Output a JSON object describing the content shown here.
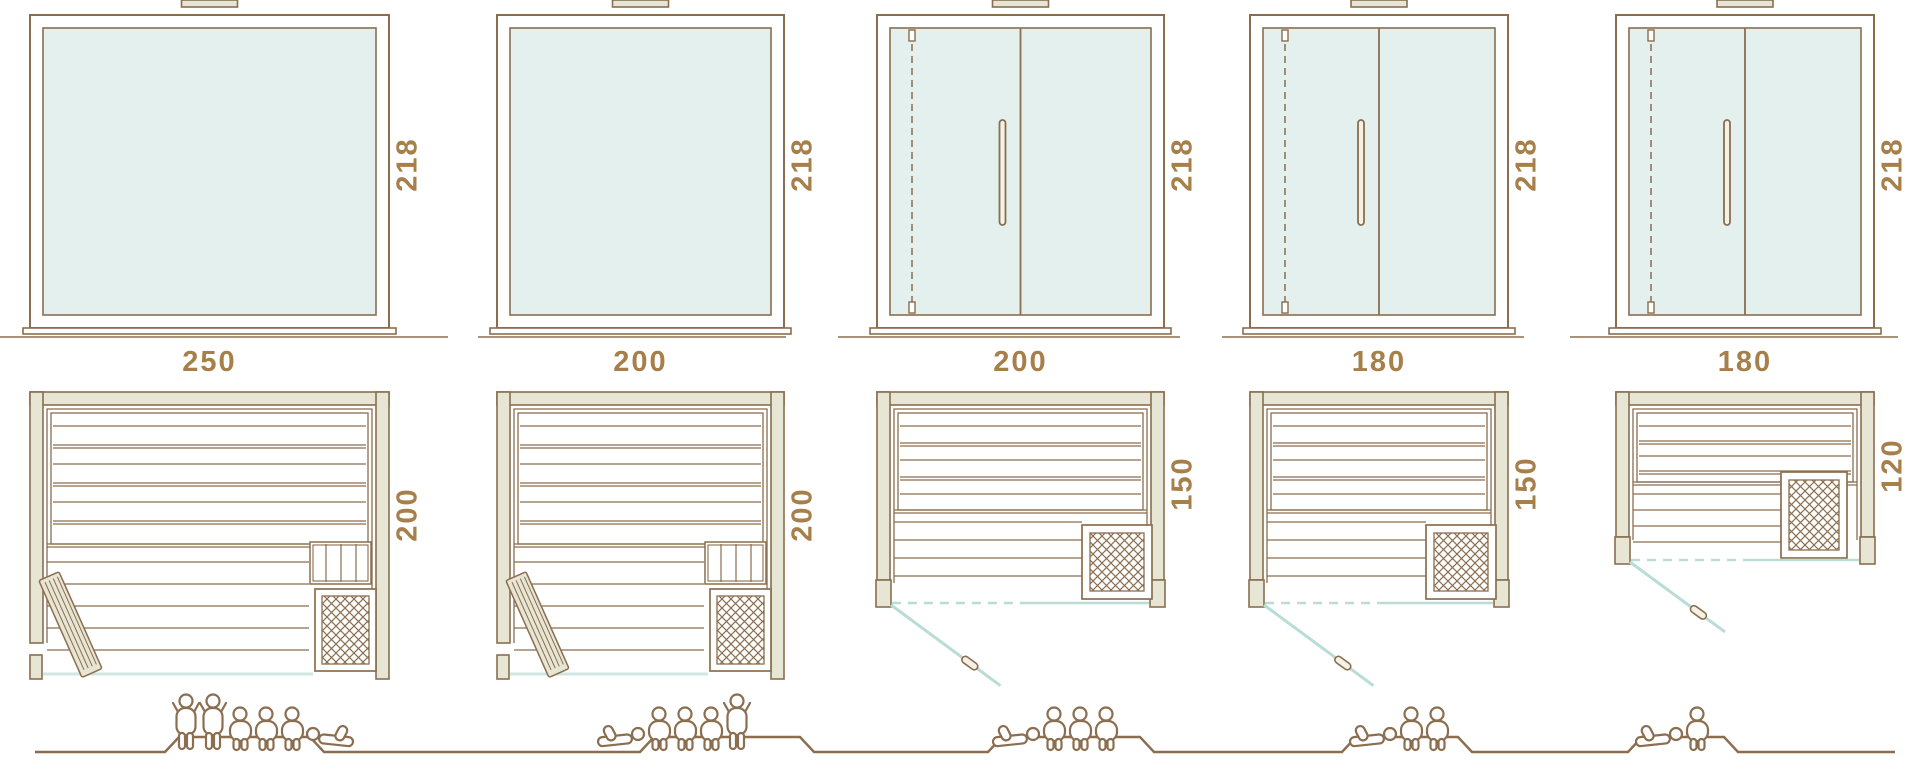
{
  "palette": {
    "line": "#8a6e4f",
    "label_text": "#a67f4a",
    "wall_fill": "#e7e5d4",
    "panel_fill": "#f4f1e6",
    "glass_fill": "#e3f0ee",
    "glass_line": "#b9dcd6",
    "front_glass_line": "#cfe7e2",
    "background": "#ffffff"
  },
  "saunas": [
    {
      "name": "sauna-250x200",
      "width_label": "250",
      "depth_label": "200",
      "height_label": "218",
      "width_cm": 250,
      "depth_cm": 200,
      "height_cm": 218,
      "elevation_door": "fixed-glass",
      "plan_door": "hinged-wood-left",
      "capacity": {
        "standing": 2,
        "sitting": 3,
        "lying": 1
      },
      "figures": [
        "standing",
        "standing",
        "sitting",
        "sitting",
        "sitting",
        "lying-head-left"
      ]
    },
    {
      "name": "sauna-200x200",
      "width_label": "200",
      "depth_label": "200",
      "height_label": "218",
      "width_cm": 200,
      "depth_cm": 200,
      "height_cm": 218,
      "elevation_door": "fixed-glass",
      "plan_door": "hinged-wood-left",
      "capacity": {
        "standing": 1,
        "sitting": 3,
        "lying": 1
      },
      "figures": [
        "lying-head-right",
        "sitting",
        "sitting",
        "sitting",
        "standing"
      ]
    },
    {
      "name": "sauna-200x150",
      "width_label": "200",
      "depth_label": "150",
      "height_label": "218",
      "width_cm": 200,
      "depth_cm": 150,
      "height_cm": 218,
      "elevation_door": "double-glass",
      "plan_door": "glass-front-left",
      "capacity": {
        "standing": 0,
        "sitting": 3,
        "lying": 1
      },
      "figures": [
        "lying-head-right",
        "sitting",
        "sitting",
        "sitting"
      ]
    },
    {
      "name": "sauna-180x150",
      "width_label": "180",
      "depth_label": "150",
      "height_label": "218",
      "width_cm": 180,
      "depth_cm": 150,
      "height_cm": 218,
      "elevation_door": "double-glass",
      "plan_door": "glass-front-left",
      "capacity": {
        "standing": 0,
        "sitting": 2,
        "lying": 1
      },
      "figures": [
        "lying-head-right",
        "sitting",
        "sitting"
      ]
    },
    {
      "name": "sauna-180x120",
      "width_label": "180",
      "depth_label": "120",
      "height_label": "218",
      "width_cm": 180,
      "depth_cm": 120,
      "height_cm": 218,
      "elevation_door": "double-glass",
      "plan_door": "glass-front-left",
      "capacity": {
        "standing": 0,
        "sitting": 1,
        "lying": 1
      },
      "figures": [
        "lying-head-right",
        "sitting"
      ]
    }
  ]
}
